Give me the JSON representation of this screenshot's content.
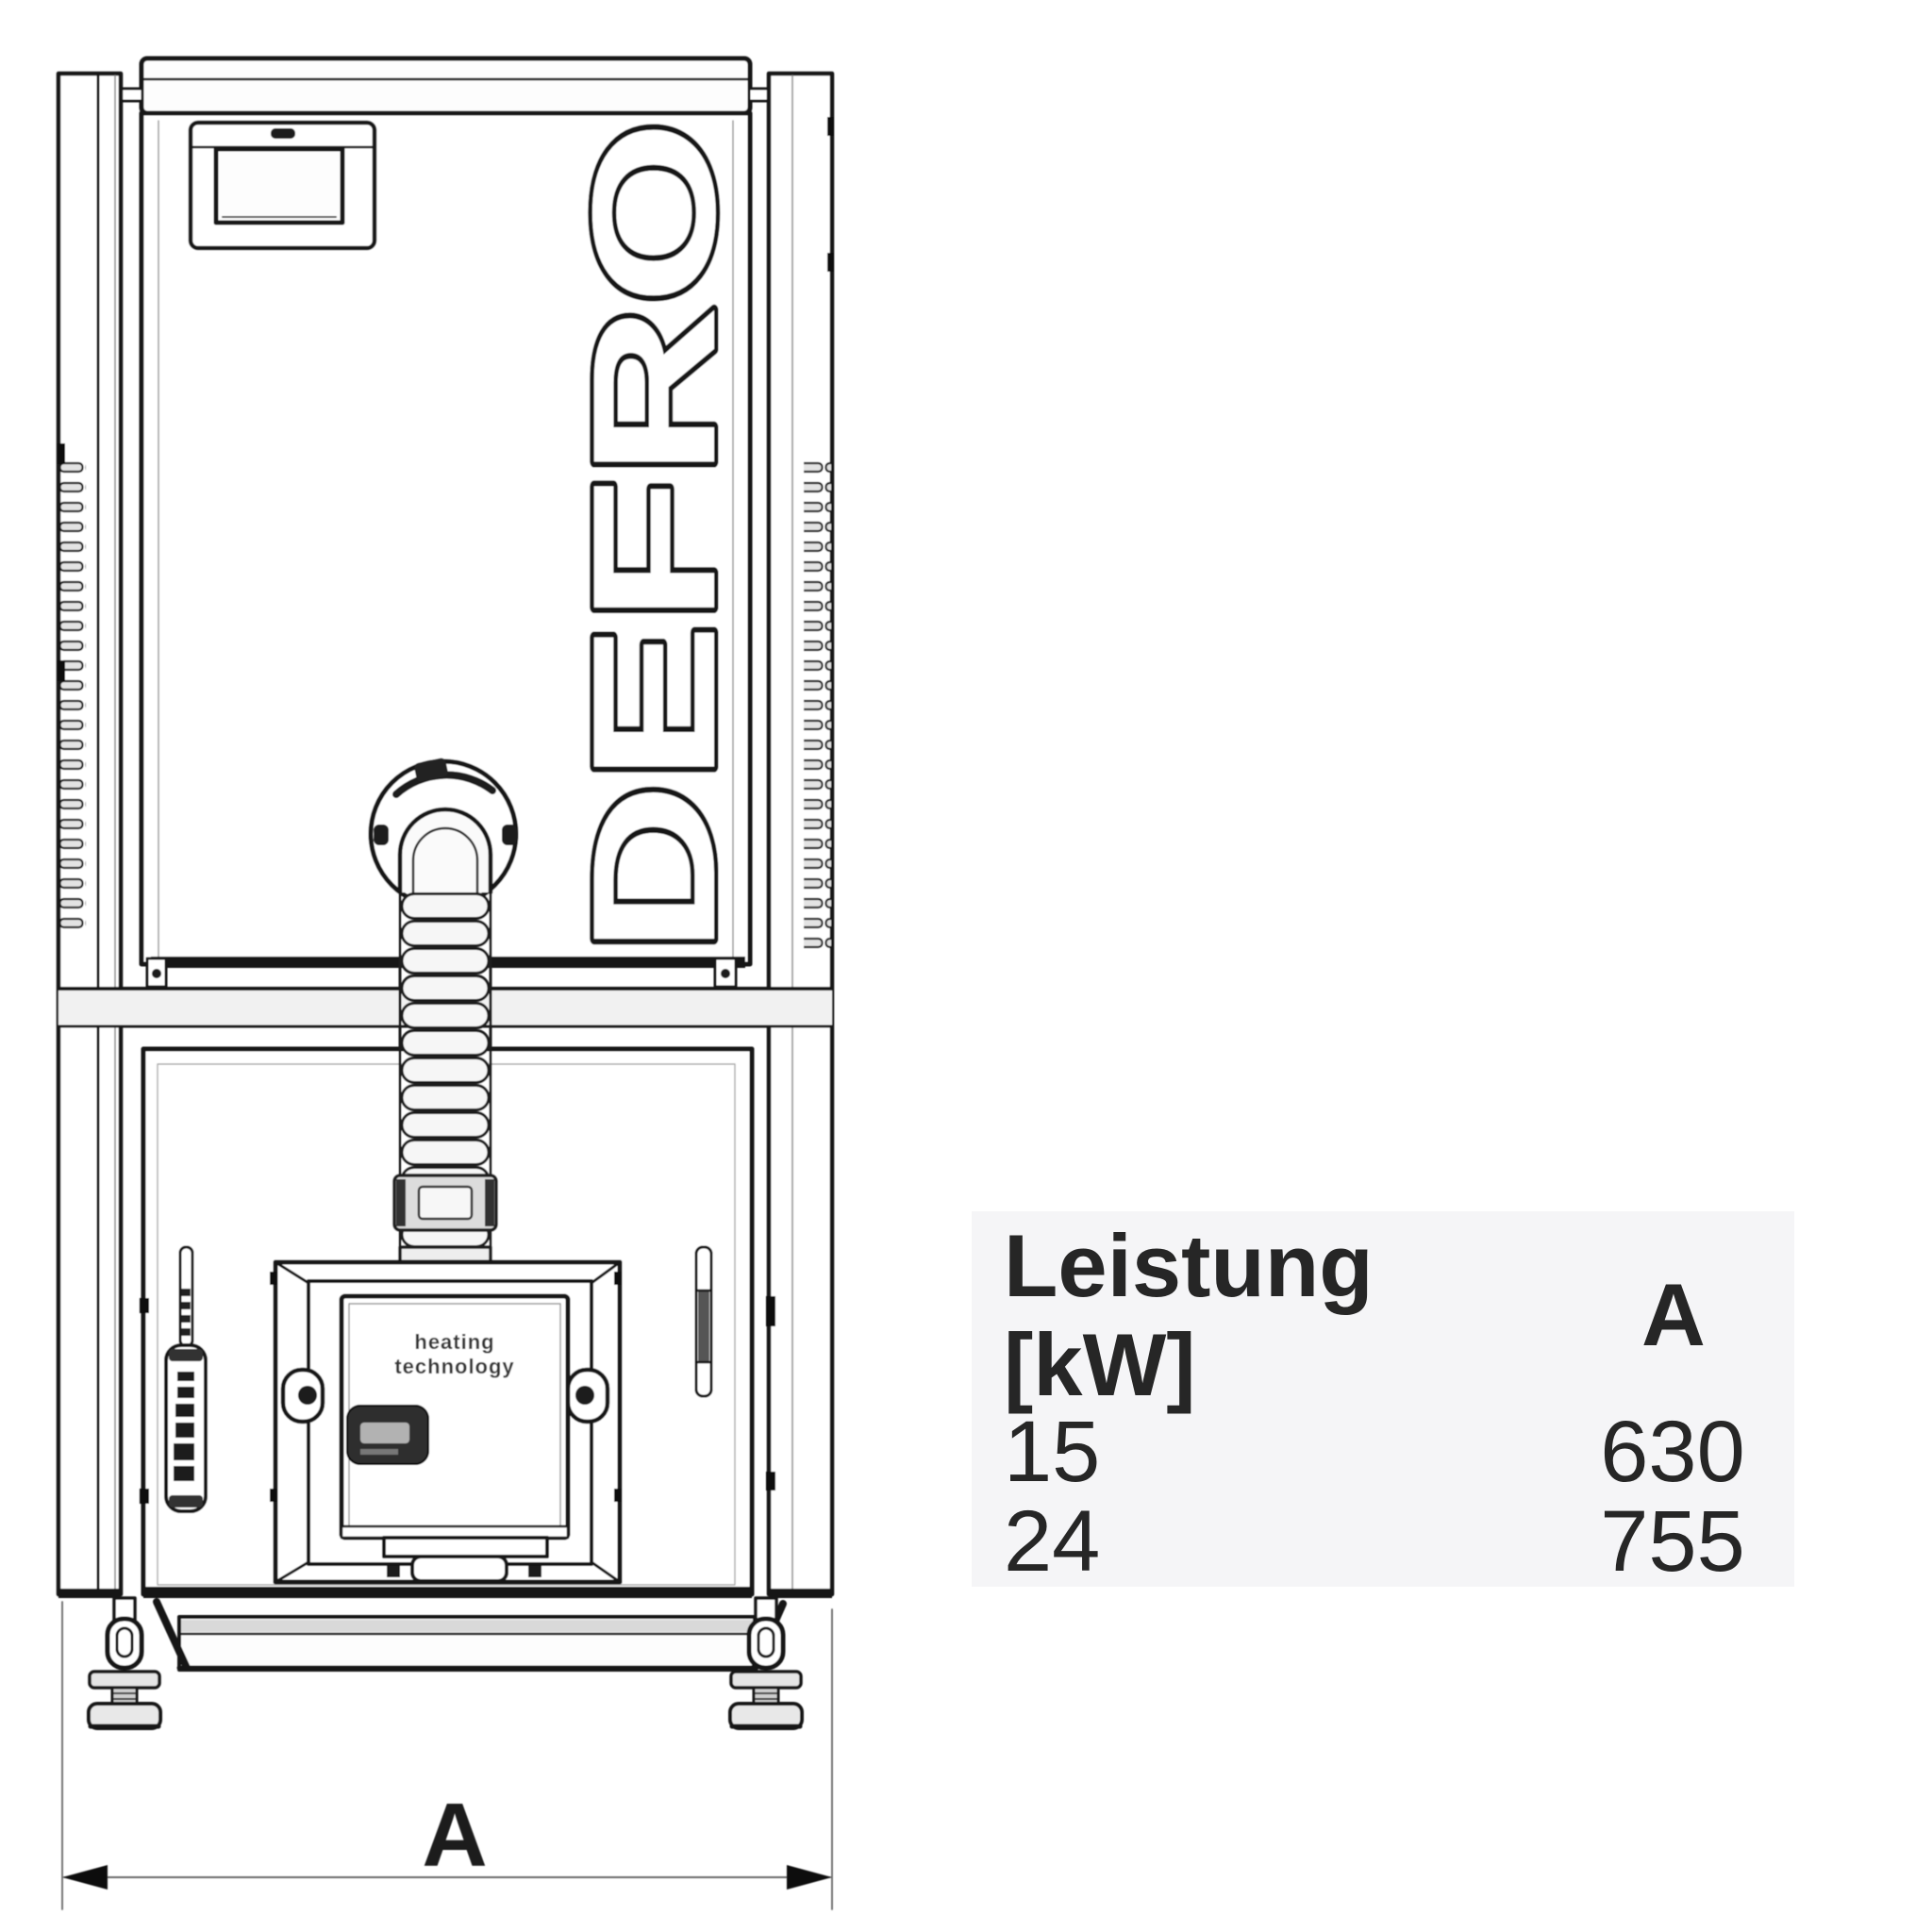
{
  "drawing": {
    "brand_logo": "DEFRO",
    "door_slogan_line1": "heating",
    "door_slogan_line2": "technology",
    "dimension_label": "A"
  },
  "spec_table": {
    "col1_header_line1": "Leistung",
    "col1_header_line2": "[kW]",
    "col2_header": "A",
    "rows": [
      {
        "power_kw": "15",
        "a_mm": "630"
      },
      {
        "power_kw": "24",
        "a_mm": "755"
      }
    ],
    "panel_bg": "#f5f5f7"
  }
}
